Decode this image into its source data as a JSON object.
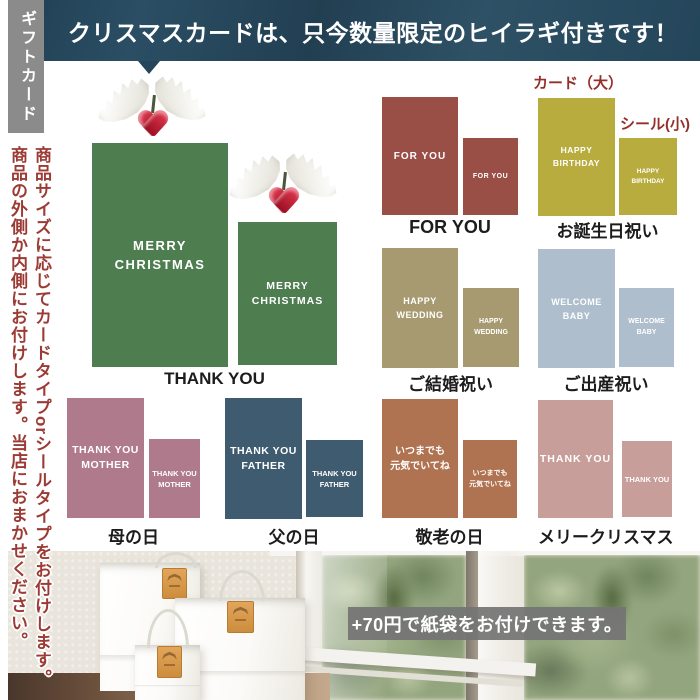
{
  "banner": {
    "text": "クリスマスカードは、只今数量限定のヒイラギ付きです！"
  },
  "sidebar": {
    "tab": "ギフトカード",
    "note1": "商品サイズに応じてカードタイプorシールタイプをお付けします。",
    "note2": "商品の外側か内側にお付けします。当店におまかせください。"
  },
  "legend": {
    "card_large": "カード（大）",
    "seal_small": "シール(小)"
  },
  "sections": {
    "christmas": {
      "large": "MERRY\nCHRISTMAS",
      "small": "MERRY\nCHRISTMAS",
      "caption": "THANK YOU",
      "color": "#4e7d50"
    },
    "foryou": {
      "large": "FOR YOU",
      "small": "FOR YOU",
      "caption": "FOR YOU",
      "color": "#9a4f46"
    },
    "birthday": {
      "large": "HAPPY\nBIRTHDAY",
      "small": "HAPPY\nBIRTHDAY",
      "caption": "お誕生日祝い",
      "color": "#b8ac3e"
    },
    "wedding": {
      "large": "HAPPY\nWEDDING",
      "small": "HAPPY\nWEDDING",
      "caption": "ご結婚祝い",
      "color": "#a79a71"
    },
    "baby": {
      "large": "WELCOME\nBABY",
      "small": "WELCOME\nBABY",
      "caption": "ご出産祝い",
      "color": "#aebecd"
    },
    "mother": {
      "large": "THANK YOU\nMOTHER",
      "small": "THANK YOU\nMOTHER",
      "caption": "母の日",
      "color": "#b07a8d"
    },
    "father": {
      "large": "THANK YOU\nFATHER",
      "small": "THANK YOU\nFATHER",
      "caption": "父の日",
      "color": "#3e5b6f"
    },
    "keirou": {
      "large": "いつまでも\n元気でいてね",
      "small": "いつまでも\n元気でいてね",
      "caption": "敬老の日",
      "color": "#b07351"
    },
    "merry": {
      "large": "THANK YOU",
      "small": "THANK YOU",
      "caption": "メリークリスマス",
      "color": "#c89e9a"
    }
  },
  "photo": {
    "badge": "+70円で紙袋をお付けできます。"
  },
  "colors": {
    "banner_bg": "#24455a",
    "tab_bg": "#8b8b8b",
    "note_red": "#9c3a34",
    "legend_red": "#93302a",
    "caption_black": "#1c1c1c",
    "tag_orange": "#d1913f",
    "berry_red": "#c51f35",
    "badge_gray": "#747474"
  }
}
